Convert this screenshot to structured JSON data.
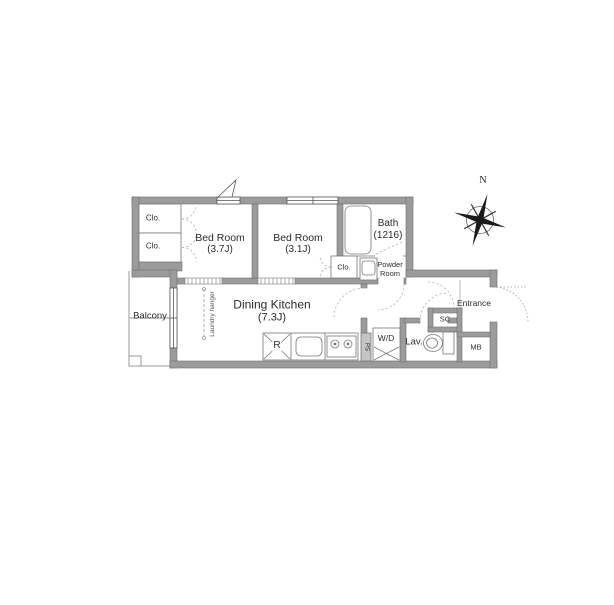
{
  "colors": {
    "wall": "#9b9b9b",
    "wall_outline": "#6f6f6f",
    "text": "#2b2b2b",
    "door_dash": "#b0b0b0"
  },
  "compass": {
    "north_label": "N"
  },
  "labels": {
    "closet1": "Clo.",
    "closet2": "Clo.",
    "closet3": "Clo.",
    "bedroom1_name": "Bed Room",
    "bedroom1_size": "(3.7J)",
    "bedroom2_name": "Bed Room",
    "bedroom2_size": "(3.1J)",
    "bath_name": "Bath",
    "bath_size": "(1216)",
    "powder_line1": "Powder",
    "powder_line2": "Room",
    "dk_name": "Dining Kitchen",
    "dk_size": "(7.3J)",
    "balcony": "Balcony",
    "laundry_hanger": "Laundry hanger",
    "refrigerator": "R",
    "pipe_shaft": "PS",
    "washer_dryer": "W/D",
    "lavatory": "Lav.",
    "shoe_closet": "SC",
    "entrance": "Entrance",
    "meter_box": "MB"
  }
}
